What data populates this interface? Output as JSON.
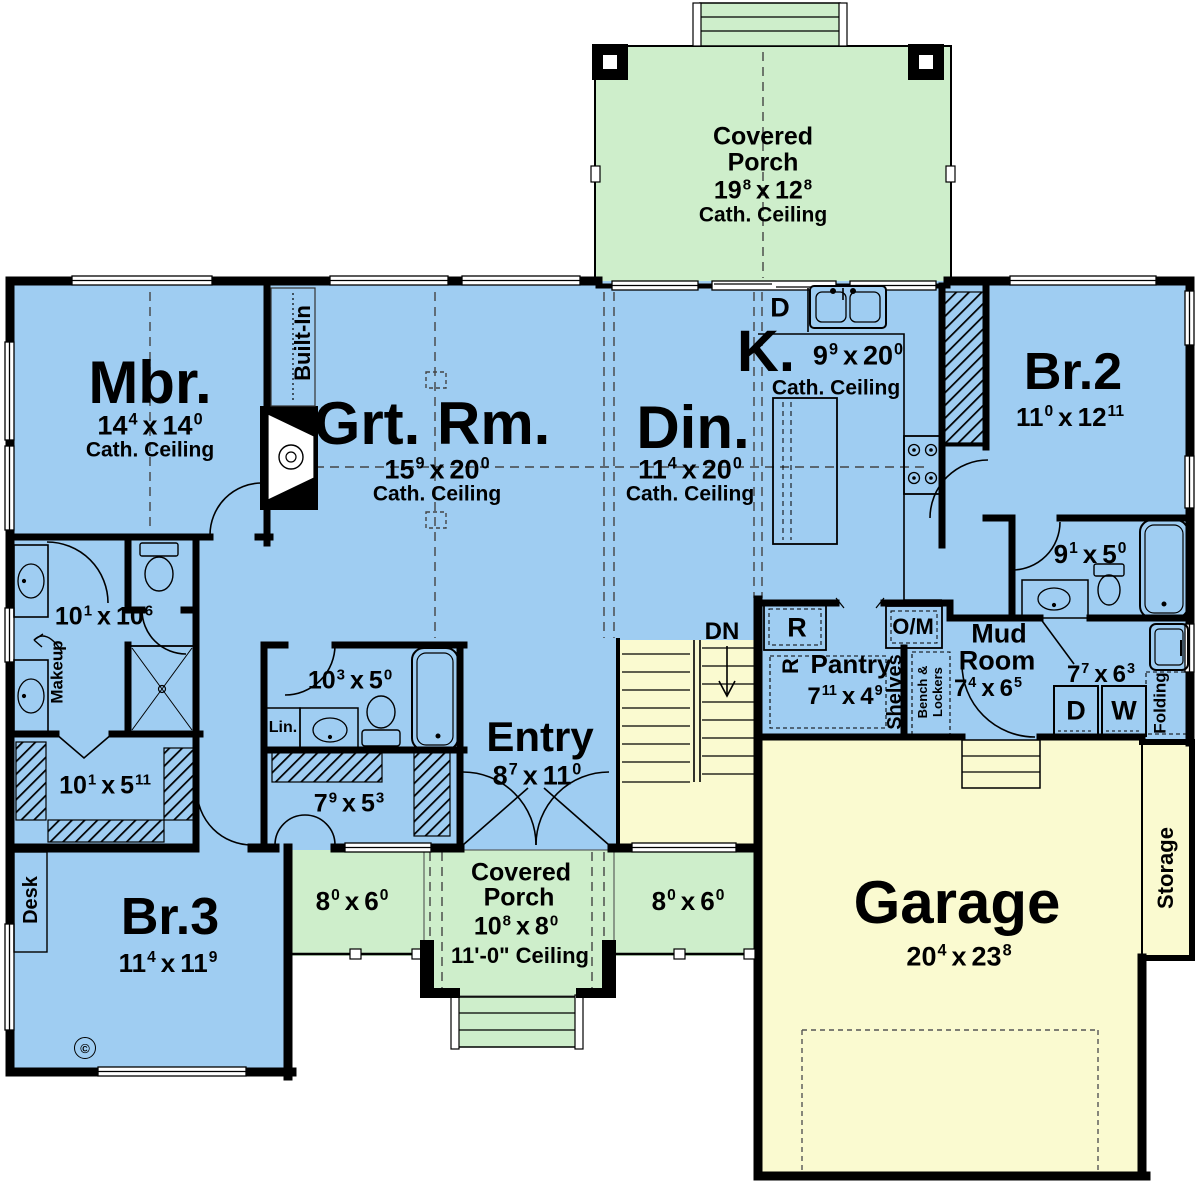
{
  "colors": {
    "floor_blue": "#9fcdf2",
    "porch_green": "#ceeecb",
    "garage_yellow": "#fafad0",
    "wall_black": "#000000"
  },
  "common": {
    "sep": "x",
    "cath_ceiling": "Cath. Ceiling"
  },
  "rooms": {
    "covered_porch_top": {
      "name_line1": "Covered",
      "name_line2": "Porch",
      "dim": {
        "w": "19",
        "ws": "8",
        "h": "12",
        "hs": "8"
      }
    },
    "master_bedroom": {
      "name": "Mbr.",
      "dim": {
        "w": "14",
        "ws": "4",
        "h": "14",
        "hs": "0"
      }
    },
    "great_room": {
      "name": "Grt. Rm.",
      "dim": {
        "w": "15",
        "ws": "9",
        "h": "20",
        "hs": "0"
      }
    },
    "dining": {
      "name": "Din.",
      "dim": {
        "w": "11",
        "ws": "4",
        "h": "20",
        "hs": "0"
      }
    },
    "kitchen": {
      "name": "K.",
      "dim": {
        "w": "9",
        "ws": "9",
        "h": "20",
        "hs": "0"
      }
    },
    "bedroom2": {
      "name": "Br.2",
      "dim": {
        "w": "11",
        "ws": "0",
        "h": "12",
        "hs": "11"
      }
    },
    "bath2": {
      "dim": {
        "w": "9",
        "ws": "1",
        "h": "5",
        "hs": "0"
      }
    },
    "mud_room": {
      "name_line1": "Mud",
      "name_line2": "Room",
      "dim": {
        "w": "7",
        "ws": "4",
        "h": "6",
        "hs": "5"
      }
    },
    "laundry": {
      "dim": {
        "w": "7",
        "ws": "7",
        "h": "6",
        "hs": "3"
      }
    },
    "pantry": {
      "name": "Pantry",
      "dim": {
        "w": "7",
        "ws": "11",
        "h": "4",
        "hs": "9"
      }
    },
    "entry": {
      "name": "Entry",
      "dim": {
        "w": "8",
        "ws": "7",
        "h": "11",
        "hs": "0"
      }
    },
    "master_bath": {
      "dim": {
        "w": "10",
        "ws": "1",
        "h": "10",
        "hs": "6"
      }
    },
    "master_closet": {
      "dim": {
        "w": "10",
        "ws": "1",
        "h": "5",
        "hs": "11"
      }
    },
    "hall_bath": {
      "dim": {
        "w": "10",
        "ws": "3",
        "h": "5",
        "hs": "0"
      }
    },
    "entry_closet": {
      "dim": {
        "w": "7",
        "ws": "9",
        "h": "5",
        "hs": "3"
      }
    },
    "bedroom3": {
      "name": "Br.3",
      "dim": {
        "w": "11",
        "ws": "4",
        "h": "11",
        "hs": "9"
      }
    },
    "covered_porch_bottom": {
      "name_line1": "Covered",
      "name_line2": "Porch",
      "dim": {
        "w": "10",
        "ws": "8",
        "h": "8",
        "hs": "0"
      },
      "ceiling": "11'-0\" Ceiling",
      "left_dim": {
        "w": "8",
        "ws": "0",
        "h": "6",
        "hs": "0"
      },
      "right_dim": {
        "w": "8",
        "ws": "0",
        "h": "6",
        "hs": "0"
      }
    },
    "garage": {
      "name": "Garage",
      "dim": {
        "w": "20",
        "ws": "4",
        "h": "23",
        "hs": "8"
      }
    }
  },
  "labels": {
    "built_in": "Built-In",
    "stairs_dn": "DN",
    "desk": "Desk",
    "makeup": "Makeup",
    "linen": "Lin.",
    "shelves": "Shelves",
    "bench_line1": "Bench &",
    "bench_line2": "Lockers",
    "folding": "Folding",
    "storage": "Storage",
    "dishwasher": "D",
    "dryer": "D",
    "washer": "W",
    "refrigerator": "R",
    "refrigerator2": "R",
    "oven_microwave": "O/M",
    "copyright": "©"
  }
}
